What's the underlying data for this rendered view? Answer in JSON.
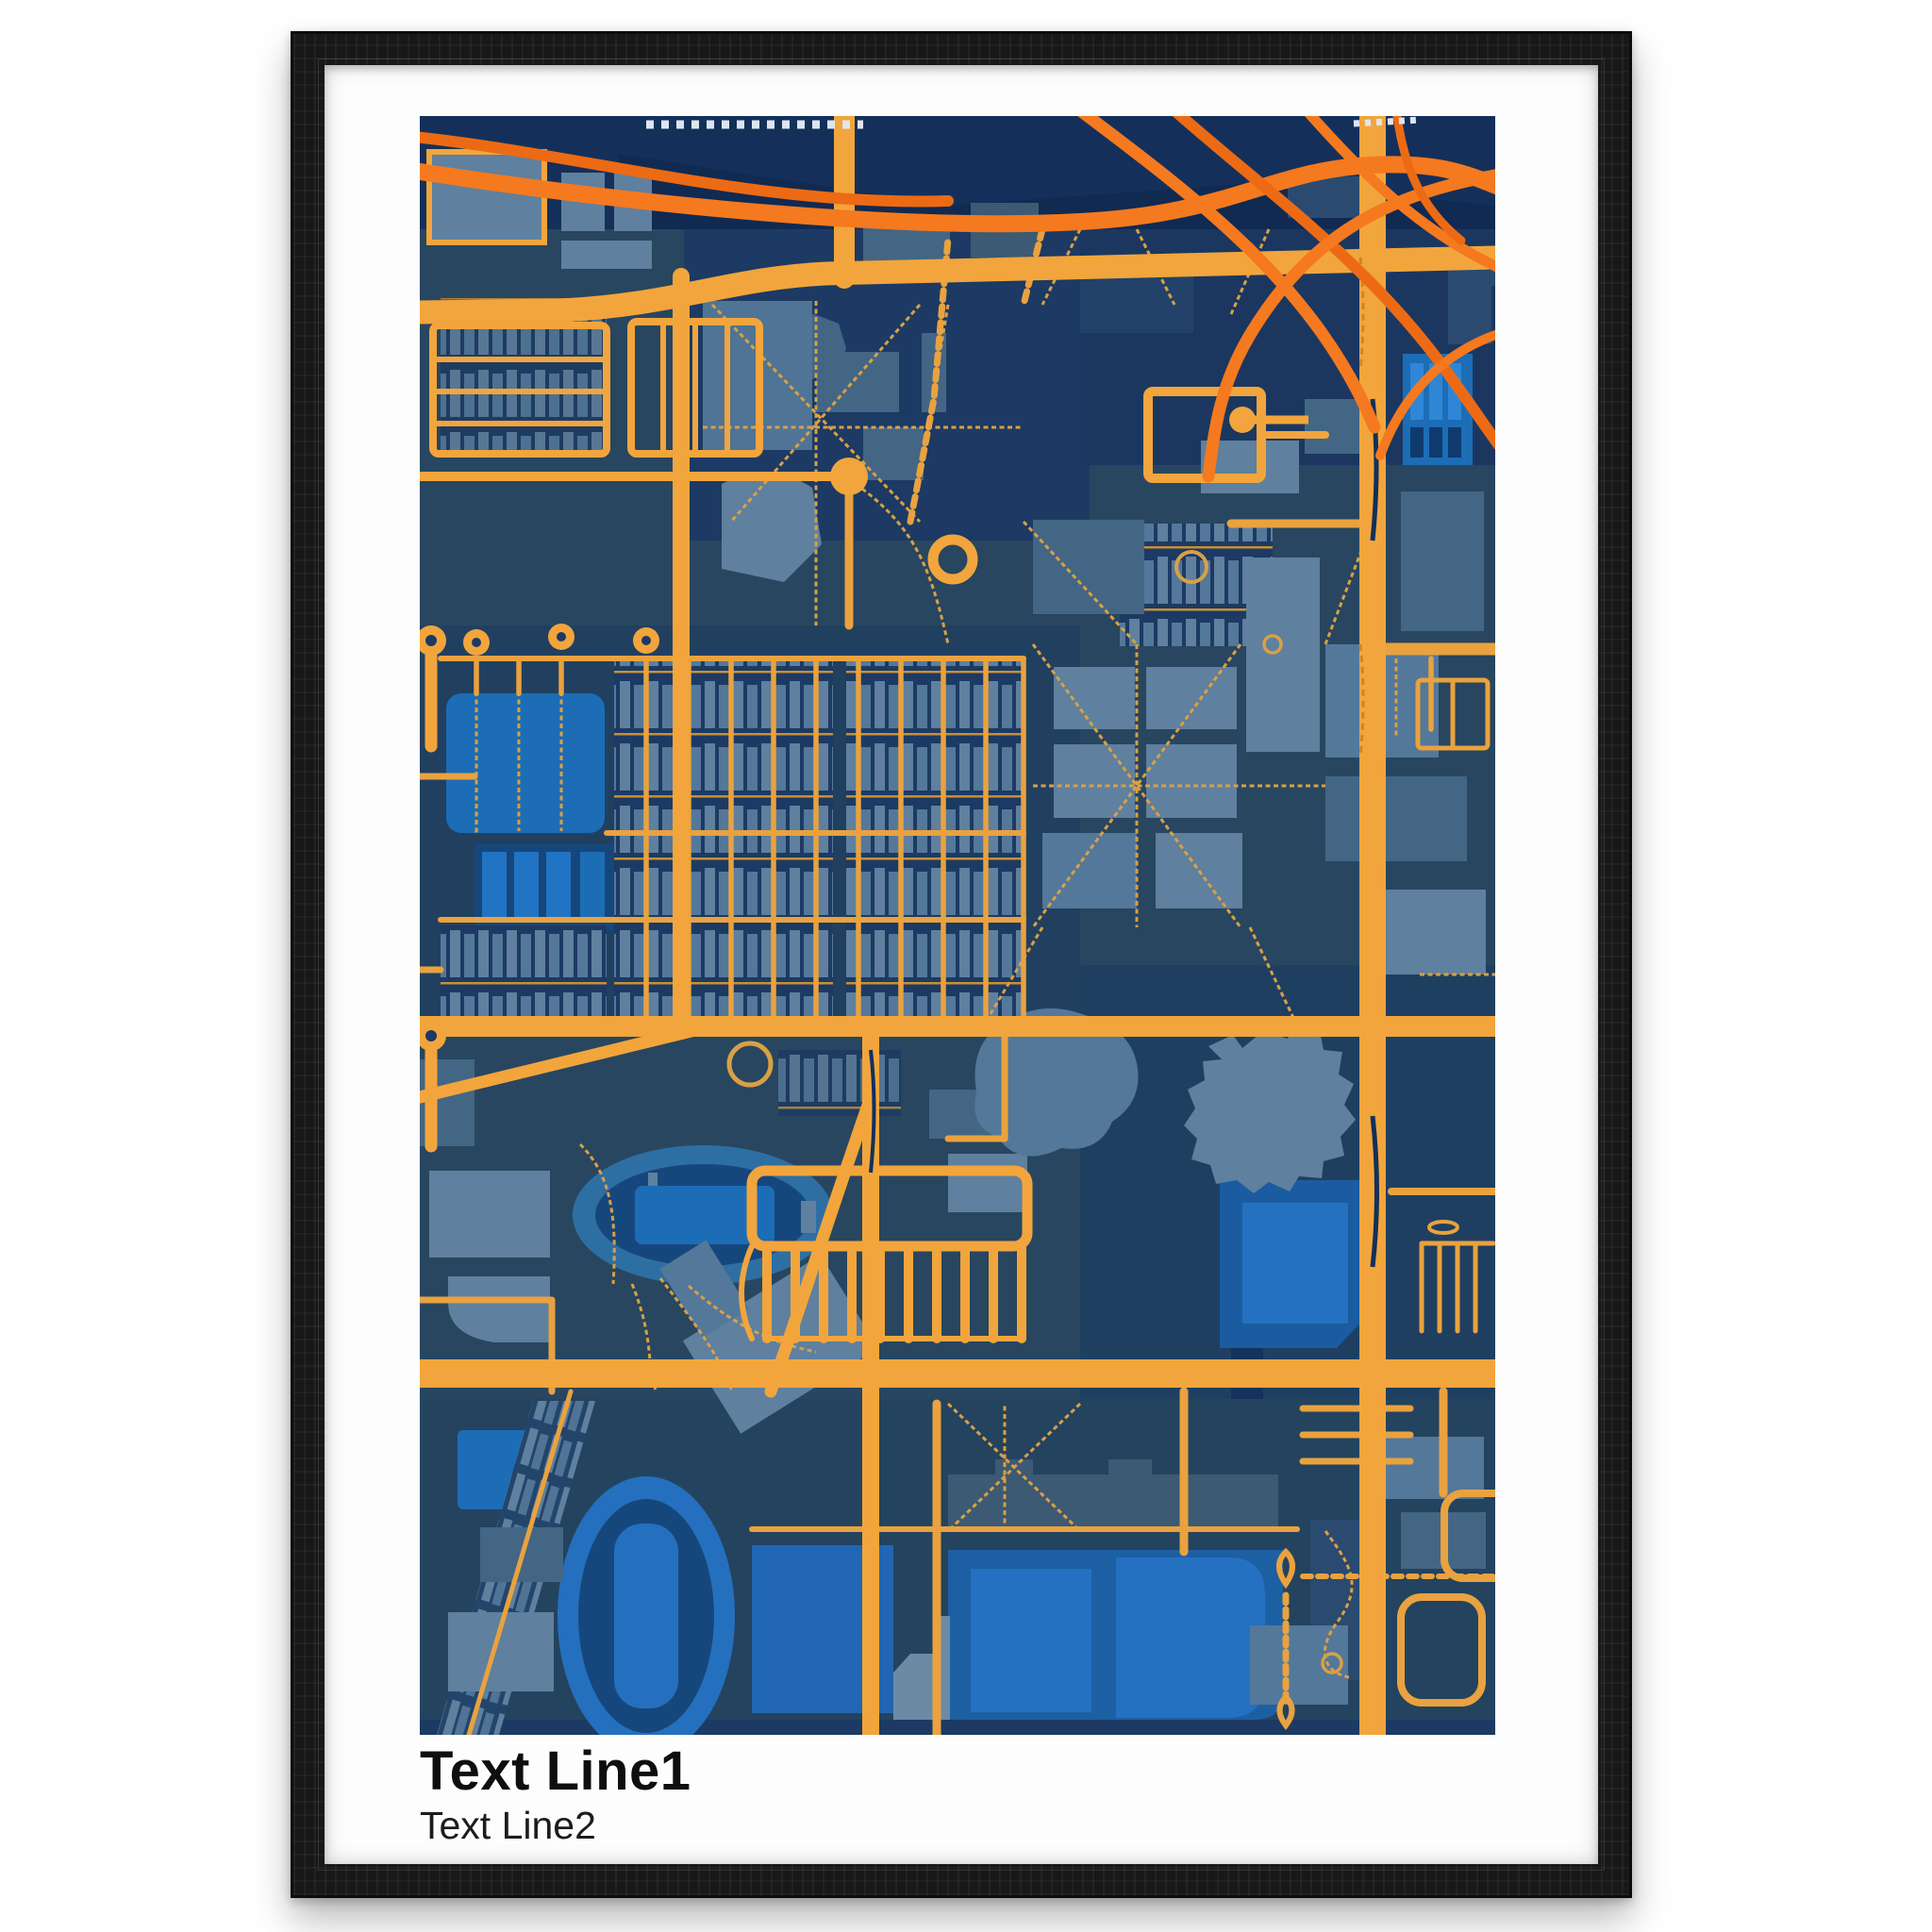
{
  "poster": {
    "title_line1": "Text Line1",
    "subtitle_line2": "Text Line2"
  },
  "frame": {
    "frame_color": "#181818",
    "mat_color": "#fdfdfd"
  },
  "map_palette": {
    "background": "#28465f",
    "background_deep_navy": "#14305a",
    "block_navy": "#1c3a63",
    "building_steel": "#5f809e",
    "building_dark": "#436685",
    "road_orange": "#f2a53c",
    "motorway_orange": "#f5791f",
    "water_sports_blue": "#1c6db6",
    "sports_blue_light": "#2471c1",
    "railway_white": "#dde6ef"
  }
}
